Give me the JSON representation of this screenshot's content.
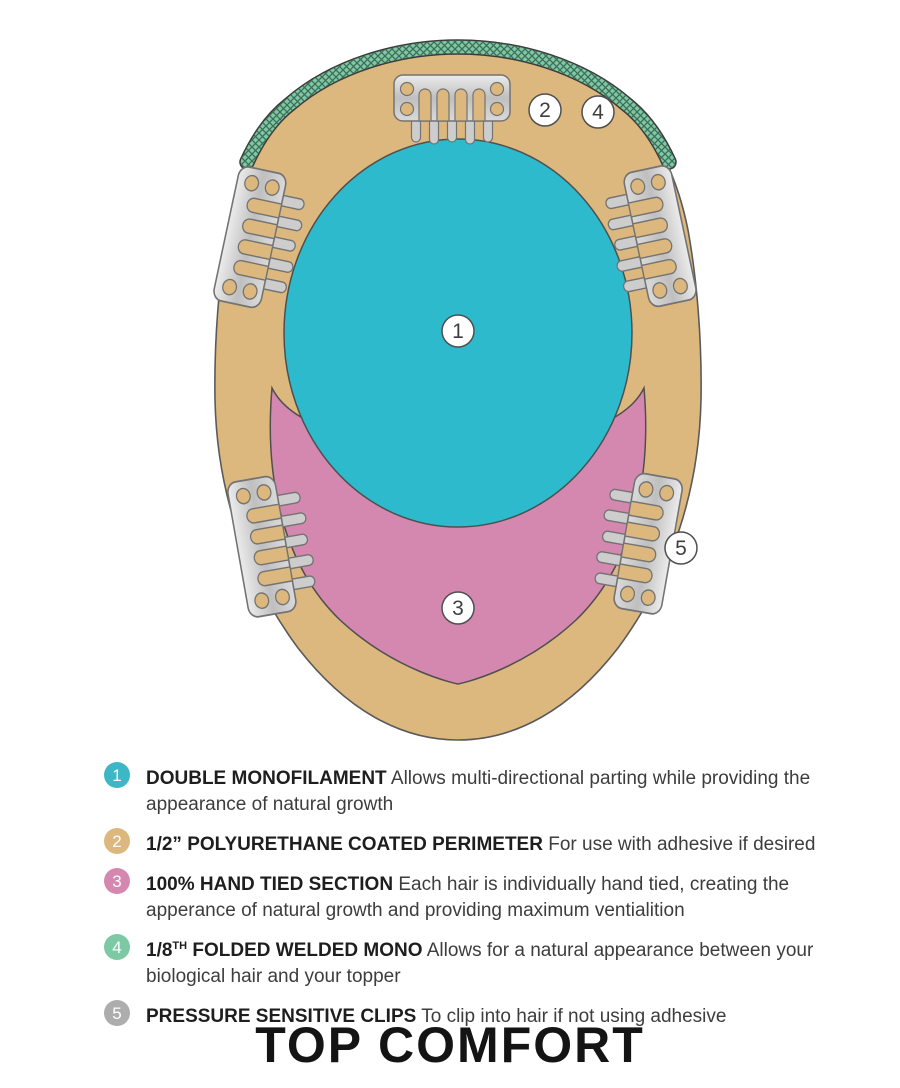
{
  "title": "TOP COMFORT",
  "colors": {
    "cap_tan": "#DDB87E",
    "monofilament_teal": "#2DBACC",
    "hand_tied_pink": "#D588AF",
    "welded_mono_green": "#7CC9A4",
    "clip_silver": "#CDCDCD",
    "legend_gray": "#ADADAD",
    "outline": "#555555"
  },
  "diagram": {
    "markers": [
      {
        "num": "1"
      },
      {
        "num": "2"
      },
      {
        "num": "3"
      },
      {
        "num": "4"
      },
      {
        "num": "5"
      }
    ]
  },
  "legend": {
    "items": [
      {
        "num": "1",
        "color": "#3DB7C6",
        "label": "DOUBLE MONOFILAMENT",
        "sup": "",
        "label2": "",
        "desc": "Allows multi-directional parting while providing the appearance of natural growth"
      },
      {
        "num": "2",
        "color": "#DDB87E",
        "label": "1/2” POLYURETHANE COATED PERIMETER",
        "sup": "",
        "label2": "",
        "desc": "For use with adhesive if desired"
      },
      {
        "num": "3",
        "color": "#D588AF",
        "label": "100% HAND TIED SECTION",
        "sup": "",
        "label2": "",
        "desc": "Each hair is individually hand tied, creating the apperance of natural growth and providing maximum ventialition"
      },
      {
        "num": "4",
        "color": "#7CC9A4",
        "label": "1/8",
        "sup": "TH",
        "label2": " FOLDED WELDED MONO",
        "desc": "Allows for a natural appearance between your biological hair and your topper"
      },
      {
        "num": "5",
        "color": "#ADADAD",
        "label": "PRESSURE SENSITIVE CLIPS",
        "sup": "",
        "label2": "",
        "desc": "To clip into hair if not using adhesive"
      }
    ]
  }
}
